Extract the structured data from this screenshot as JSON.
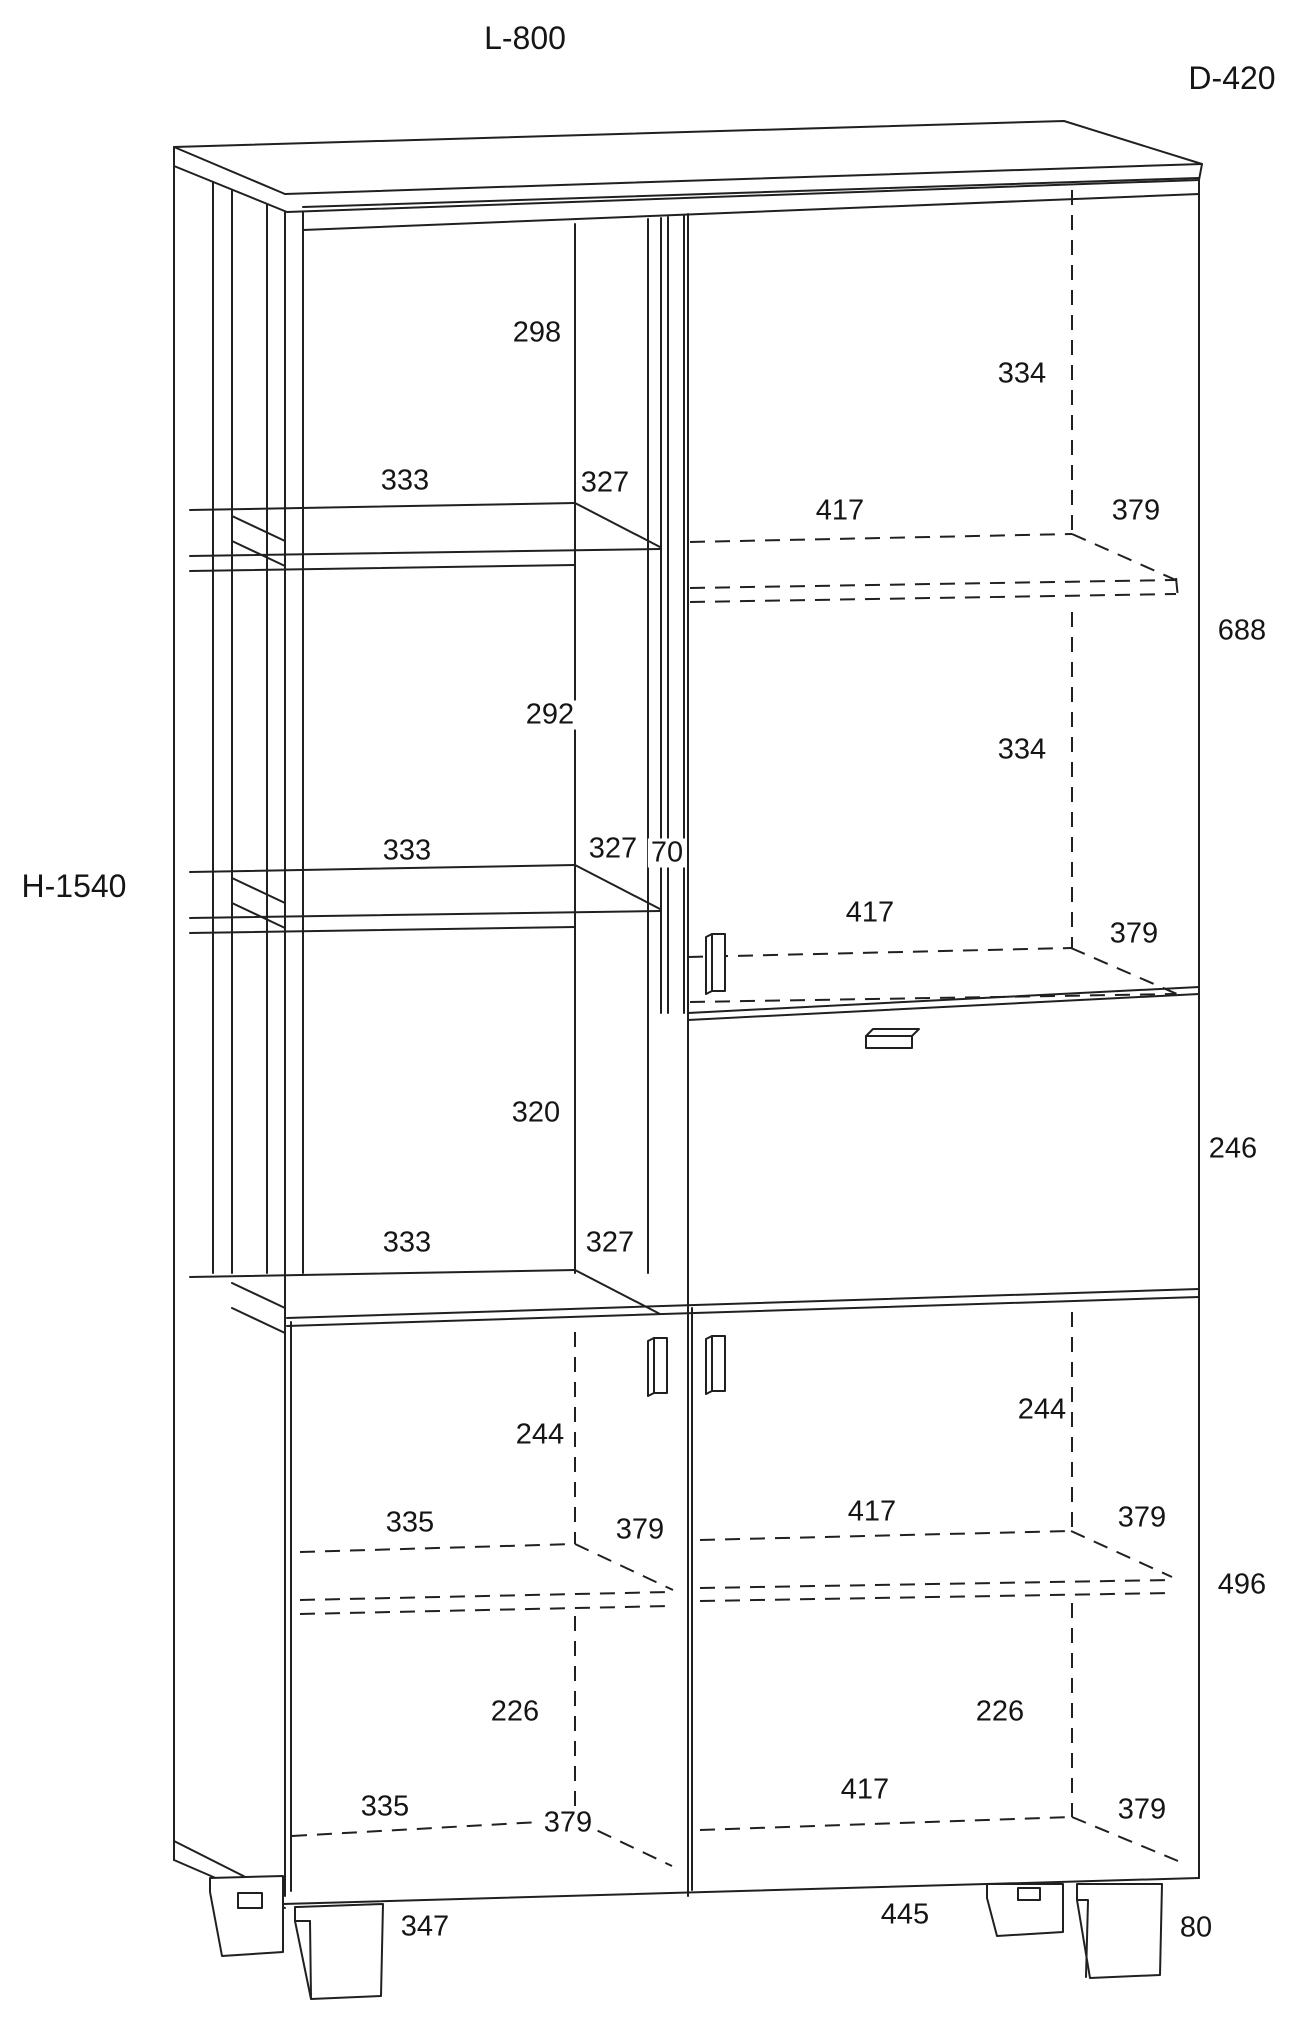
{
  "page": {
    "background": "#ffffff",
    "line_color": "#202020",
    "text_color": "#151515"
  },
  "overall_dimensions": {
    "width_label": "L-800",
    "depth_label": "D-420",
    "height_label": "H-1540"
  },
  "dims": [
    {
      "text": "298"
    },
    {
      "text": "334"
    },
    {
      "text": "333"
    },
    {
      "text": "327"
    },
    {
      "text": "417"
    },
    {
      "text": "379"
    },
    {
      "text": "688"
    },
    {
      "text": "292"
    },
    {
      "text": "334"
    },
    {
      "text": "333"
    },
    {
      "text": "327"
    },
    {
      "text": "70"
    },
    {
      "text": "417"
    },
    {
      "text": "379"
    },
    {
      "text": "320"
    },
    {
      "text": "246"
    },
    {
      "text": "333"
    },
    {
      "text": "327"
    },
    {
      "text": "244"
    },
    {
      "text": "244"
    },
    {
      "text": "335"
    },
    {
      "text": "379"
    },
    {
      "text": "417"
    },
    {
      "text": "379"
    },
    {
      "text": "496"
    },
    {
      "text": "226"
    },
    {
      "text": "226"
    },
    {
      "text": "335"
    },
    {
      "text": "379"
    },
    {
      "text": "417"
    },
    {
      "text": "379"
    },
    {
      "text": "347"
    },
    {
      "text": "445"
    },
    {
      "text": "80"
    }
  ]
}
